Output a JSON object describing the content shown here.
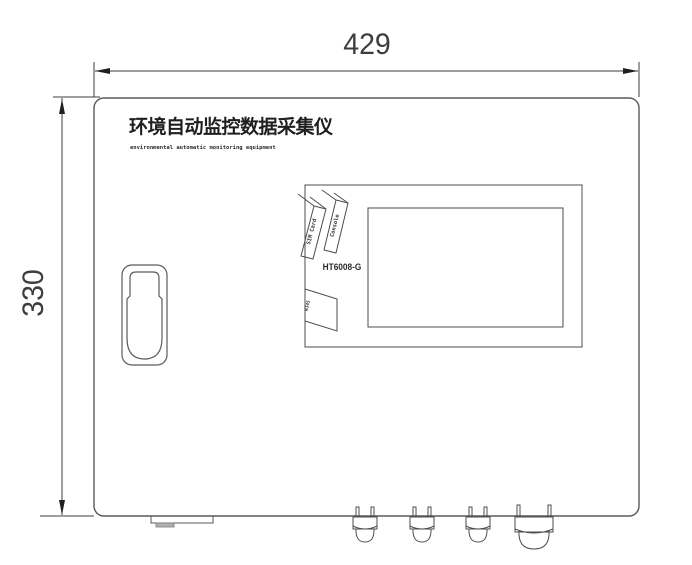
{
  "device_drawing": {
    "title_cn": "环境自动监控数据采集仪",
    "title_en": "environmental automatic monitoring equipment",
    "model": "HT6008-G",
    "width_dimension": "429",
    "height_dimension": "330",
    "port_labels": {
      "console": "Console",
      "sim_card": "SIM Card",
      "rj45": "RJ45"
    },
    "colors": {
      "line": "#4d4d4d",
      "dimension_line": "#3c3c3c",
      "arrow_fill": "#1f1f1f",
      "text": "#262626",
      "background": "#ffffff"
    }
  }
}
